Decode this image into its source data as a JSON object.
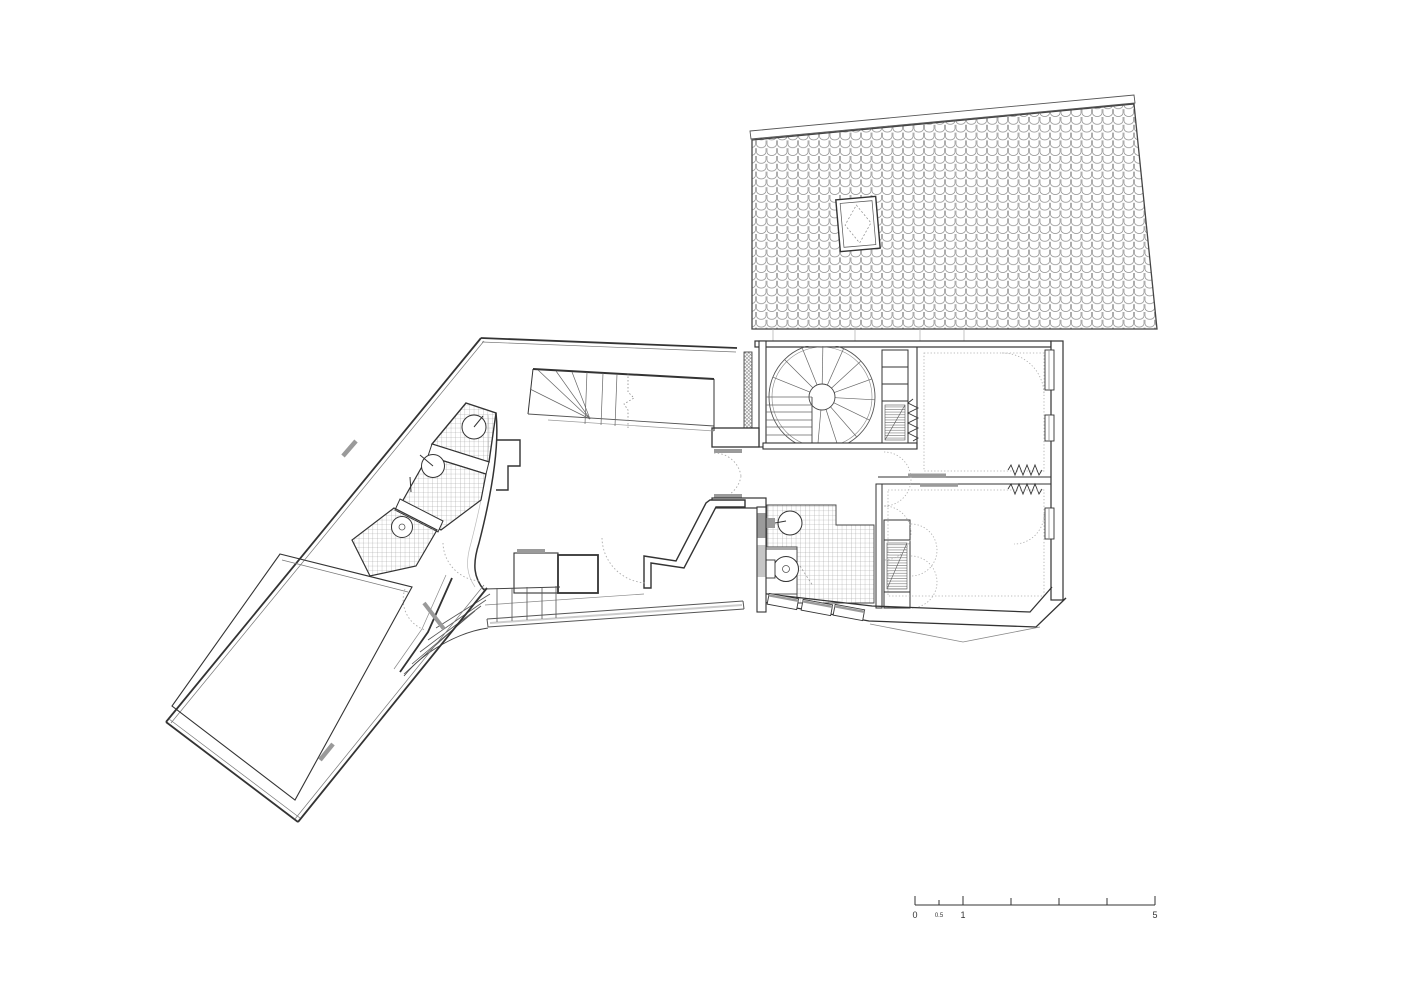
{
  "document": {
    "type": "architectural floor plan",
    "background": "#ffffff"
  },
  "palette": {
    "line": "#333333",
    "medium_line": "#555555",
    "light_line": "#8a8a8a",
    "tile_line": "#9a9a9a",
    "fixture_gray": "#9a9a9a",
    "soft_gray": "#bbbbbb"
  },
  "scale_bar": {
    "zero": "0",
    "half": "0.5",
    "one": "1",
    "five": "5"
  }
}
